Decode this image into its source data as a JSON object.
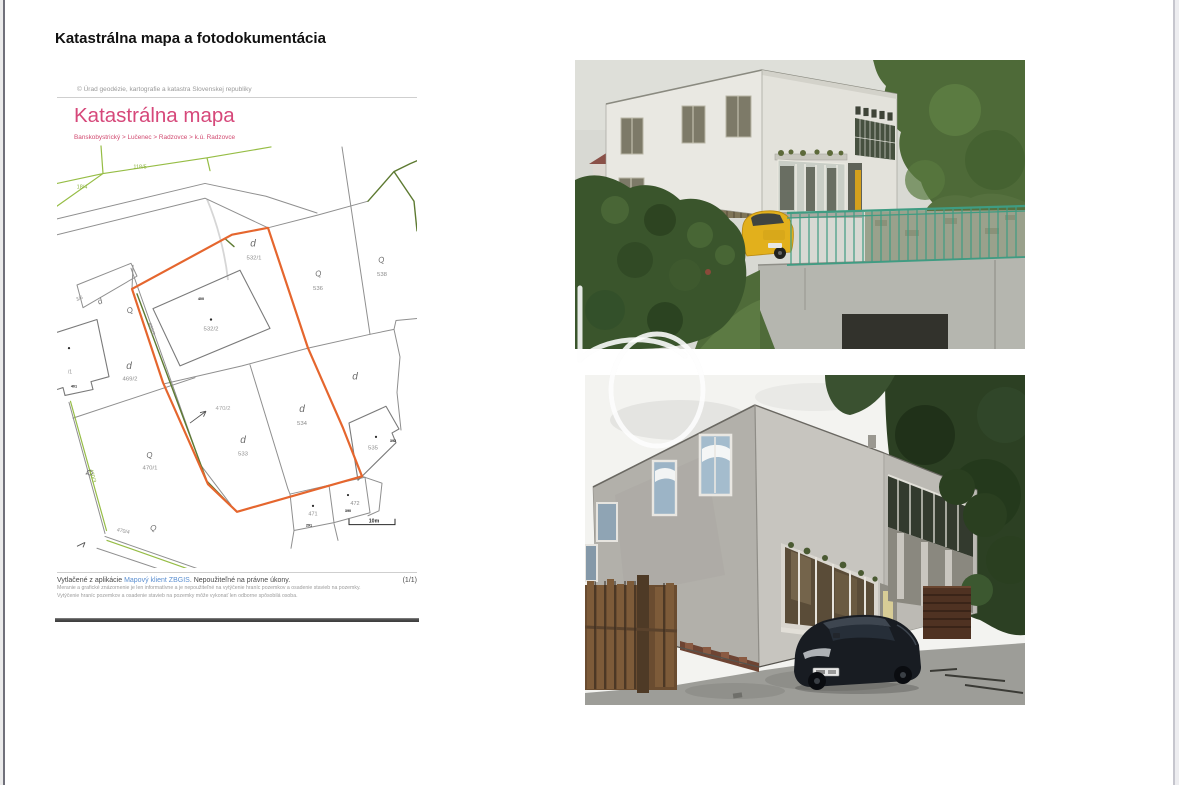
{
  "page": {
    "title": "Katastrálna mapa a fotodokumentácia"
  },
  "map": {
    "copyright": "© Úrad geodézie, kartografie a katastra Slovenskej republiky",
    "title": "Katastrálna mapa",
    "breadcrumb": "Banskobystrický > Lučenec > Radzovce > k.ú. Radzovce",
    "footer": {
      "printed_prefix": "Vytlačené z aplikácie ",
      "app_link": "Mapový klient ZBGIS",
      "printed_suffix": ". Nepoužiteľné na právne úkony.",
      "page_indicator": "(1/1)",
      "disclaimer_line1": "Meranie a grafické znázornenie je len informatívne a je nepoužiteľné na vytýčenie hraníc pozemkov a osadenie stavieb na pozemky.",
      "disclaimer_line2": "Vytýčenie hraníc pozemkov a osadenie stavieb na pozemky môže vykonať len odborne spôsobilá osoba."
    },
    "scale_label": "10m",
    "colors": {
      "highlight_parcel": "#e5662e",
      "map_line": "#8f8f8f",
      "vegetation_green": "#96bd45",
      "olive_line": "#5d7a31",
      "title_pink": "#d6487a",
      "link_blue": "#5b8fd0"
    },
    "labels": [
      {
        "t": "118/5",
        "k": "green",
        "x": 83,
        "y": 25
      },
      {
        "t": "18/4",
        "k": "green",
        "x": 25,
        "y": 45
      },
      {
        "t": "470/3",
        "k": "green",
        "x": 34,
        "y": 337,
        "r": 75
      },
      {
        "t": "532/1",
        "k": "parcel",
        "x": 197,
        "y": 117
      },
      {
        "t": "d",
        "k": "sym-d",
        "x": 196,
        "y": 104
      },
      {
        "t": "532/2",
        "k": "parcel",
        "x": 154,
        "y": 189
      },
      {
        "t": "536",
        "k": "parcel",
        "x": 261,
        "y": 148
      },
      {
        "t": "Q",
        "k": "sym-q",
        "x": 262,
        "y": 134,
        "r": -15
      },
      {
        "t": "538",
        "k": "parcel",
        "x": 325,
        "y": 134
      },
      {
        "t": "Q",
        "k": "sym-q",
        "x": 325,
        "y": 120,
        "r": -15
      },
      {
        "t": "469/2",
        "k": "parcel",
        "x": 73,
        "y": 240
      },
      {
        "t": "d",
        "k": "sym-d",
        "x": 72,
        "y": 228
      },
      {
        "t": "469/3",
        "k": "parcel",
        "x": 93,
        "y": 188,
        "r": 72,
        "s": 5.2
      },
      {
        "t": "470/2",
        "k": "parcel-light",
        "x": 166,
        "y": 270
      },
      {
        "t": "533",
        "k": "parcel",
        "x": 186,
        "y": 316
      },
      {
        "t": "d",
        "k": "sym-d",
        "x": 186,
        "y": 303
      },
      {
        "t": "534",
        "k": "parcel",
        "x": 245,
        "y": 285
      },
      {
        "t": "d",
        "k": "sym-d",
        "x": 245,
        "y": 272
      },
      {
        "t": "d",
        "k": "sym-d",
        "x": 298,
        "y": 239
      },
      {
        "t": "470/1",
        "k": "parcel",
        "x": 93,
        "y": 330
      },
      {
        "t": "Q",
        "k": "sym-q",
        "x": 93,
        "y": 318,
        "r": -10
      },
      {
        "t": "535",
        "k": "parcel",
        "x": 316,
        "y": 310
      },
      {
        "t": "471",
        "k": "parcel",
        "x": 256,
        "y": 377,
        "s": 5.5
      },
      {
        "t": "472",
        "k": "parcel",
        "x": 298,
        "y": 366,
        "s": 5.5
      },
      {
        "t": "Q",
        "k": "sym-q",
        "x": 74,
        "y": 171,
        "r": -25
      },
      {
        "t": "Q",
        "k": "sym-q",
        "x": 30,
        "y": 334,
        "r": 75
      },
      {
        "t": "Q",
        "k": "sym-q",
        "x": 96,
        "y": 392,
        "r": 8
      },
      {
        "t": "470/4",
        "k": "parcel",
        "x": 66,
        "y": 394,
        "r": 12,
        "s": 5.2
      },
      {
        "t": "3/6",
        "k": "parcel",
        "x": 23,
        "y": 158,
        "r": -24,
        "s": 5
      },
      {
        "t": "d",
        "k": "sym-d",
        "x": 44,
        "y": 162,
        "r": -24,
        "s": 8
      },
      {
        "t": "/1",
        "k": "parcel",
        "x": 13,
        "y": 233,
        "s": 5.2
      },
      {
        "t": "400",
        "k": "chip",
        "x": 144,
        "y": 158
      },
      {
        "t": "392",
        "k": "chip",
        "x": 336,
        "y": 302
      },
      {
        "t": "291",
        "k": "chip",
        "x": 252,
        "y": 388
      },
      {
        "t": "390",
        "k": "chip",
        "x": 291,
        "y": 373
      },
      {
        "t": "401",
        "k": "chip",
        "x": 17,
        "y": 247
      },
      {
        "t": "10m",
        "k": "scale",
        "x": 317,
        "y": 384
      }
    ]
  },
  "photos": [
    {
      "name": "photo-building-street-side"
    },
    {
      "name": "photo-building-yard-side"
    }
  ]
}
